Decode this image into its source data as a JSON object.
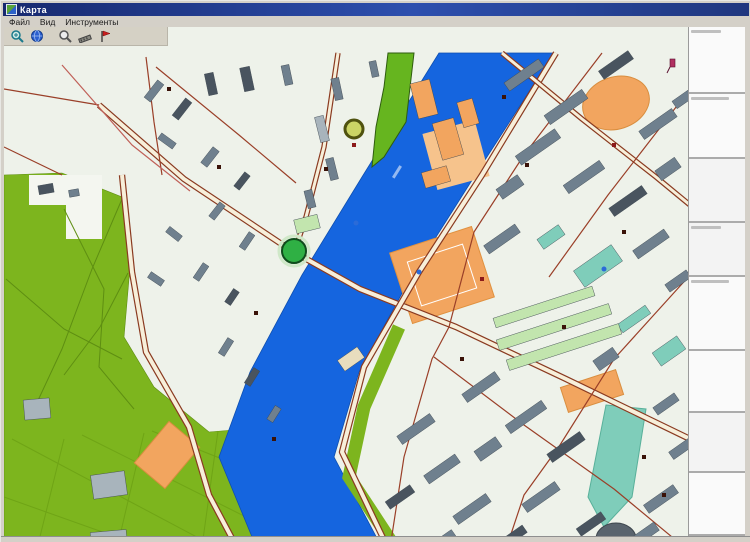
{
  "window": {
    "title": "Карта"
  },
  "menu": {
    "items": [
      {
        "id": "file",
        "label": "Файл"
      },
      {
        "id": "view",
        "label": "Вид"
      },
      {
        "id": "tools",
        "label": "Инструменты"
      }
    ]
  },
  "toolbar": {
    "buttons": [
      {
        "icon": "zoom-in-icon"
      },
      {
        "icon": "globe-icon"
      },
      {
        "icon": "search-icon"
      },
      {
        "icon": "measure-icon"
      },
      {
        "icon": "flag-icon"
      }
    ]
  },
  "sidebar": {
    "sections": [
      {
        "h": 67,
        "header": true,
        "alt": false
      },
      {
        "h": 65,
        "header": true,
        "alt": false
      },
      {
        "h": 64,
        "header": false,
        "alt": true
      },
      {
        "h": 54,
        "header": true,
        "alt": true
      },
      {
        "h": 74,
        "header": true,
        "alt": false
      },
      {
        "h": 62,
        "header": false,
        "alt": false
      },
      {
        "h": 60,
        "header": false,
        "alt": true
      },
      {
        "h": 63,
        "header": false,
        "alt": false
      }
    ]
  },
  "map": {
    "colors": {
      "bg": "#EEF2EA",
      "water": "#1565DF",
      "waterEdge": "#0E4FB0",
      "park": "#7DB51E",
      "parkLine": "#5E8E12",
      "boulevard": "#66B51F",
      "roadCase": "#8A3A20",
      "roadFill": "#F7EFDA",
      "roadMinor": "#9A3F28",
      "roadPink": "#C06058",
      "g": "#6F808E",
      "d": "#49545F",
      "l": "#A8B4BC",
      "t": "#7FCDBA",
      "m": "#C2E5AE",
      "o": "#F2A55F",
      "w": "#E8DDBE"
    },
    "river": "435,26 358,150 298,248 246,345 215,430 258,534 385,534 330,430 355,345 408,248 470,150 550,26",
    "park": "0,148 58,146 118,170 126,240 120,310 150,360 205,405 292,398 268,534 0,534",
    "notch": "25,148 98,148 98,212 62,212 62,178 25,178",
    "boulevard": "384,26 410,26 402,95 380,130 368,140 372,100 380,60",
    "bank_strip": "395,300 360,380 345,450 400,534",
    "park_paths": [
      "60,182 100,262 95,340 130,382",
      "118,172 88,242 58,322 30,382",
      "2,252 60,302 118,332",
      "124,246 96,300 60,348"
    ],
    "field_lines": [
      "8,412 238,534",
      "78,408 266,502",
      "148,404 268,452",
      "60,412 30,534",
      "140,406 110,534",
      "214,404 196,534",
      "0,470 180,534"
    ],
    "areas": [
      {
        "shape": "ellipse",
        "x": 612,
        "y": 76,
        "rx": 34,
        "ry": 26,
        "rot": -18,
        "c": "o",
        "s": "#D98E3F"
      },
      {
        "shape": "rect",
        "x": 452,
        "y": 128,
        "w": 54,
        "h": 58,
        "rot": -15,
        "c": "#F6C38C",
        "s": "none"
      },
      {
        "shape": "rect",
        "x": 438,
        "y": 248,
        "w": 86,
        "h": 74,
        "rot": -18,
        "c": "o",
        "s": "#E0913F"
      },
      {
        "shape": "rect",
        "x": 438,
        "y": 248,
        "w": 58,
        "h": 46,
        "rot": -18,
        "c": "none",
        "s": "#FFFFFF"
      },
      {
        "shape": "rect",
        "x": 163,
        "y": 428,
        "w": 54,
        "h": 40,
        "rot": -50,
        "c": "o",
        "s": "#D98E3F"
      },
      {
        "shape": "rect",
        "x": 588,
        "y": 364,
        "w": 58,
        "h": 26,
        "rot": -18,
        "c": "o",
        "s": "#D98E3F"
      },
      {
        "shape": "poly",
        "pts": "602,378 642,382 628,470 600,500 584,470",
        "c": "t",
        "s": "#58B09A"
      },
      {
        "shape": "ellipse",
        "x": 612,
        "y": 512,
        "rx": 20,
        "ry": 16,
        "rot": 0,
        "c": "#5A646E",
        "s": "#3E464E"
      }
    ],
    "roads": [
      {
        "p": "118,148 128,245 142,325 185,400 205,468 240,534",
        "w": 4,
        "major": true
      },
      {
        "p": "95,78 180,152 288,224 356,262 452,300 562,352 686,412",
        "w": 4,
        "major": true
      },
      {
        "p": "552,26 478,148 415,245 360,340 338,425 390,534",
        "w": 4,
        "major": true
      },
      {
        "p": "498,26 578,92 652,150 686,178",
        "w": 3,
        "major": true
      },
      {
        "p": "334,26 320,120 302,190 292,220",
        "w": 3,
        "major": true
      },
      {
        "p": "598,26 520,128 470,205",
        "w": 1.2,
        "c": "minor"
      },
      {
        "p": "686,62 604,168 545,250",
        "w": 1.2,
        "c": "minor"
      },
      {
        "p": "686,248 610,332",
        "w": 1.2,
        "c": "minor"
      },
      {
        "p": "430,330 520,398 610,462 668,510",
        "w": 1.2,
        "c": "minor"
      },
      {
        "p": "470,205 445,300 428,332 400,430 384,534",
        "w": 1.2,
        "c": "minor"
      },
      {
        "p": "610,332 556,418 520,468 498,534",
        "w": 1.2,
        "c": "minor"
      },
      {
        "p": "0,62 95,78",
        "w": 1.2,
        "c": "minor"
      },
      {
        "p": "142,30 150,95 158,148",
        "w": 1.2,
        "c": "minor"
      },
      {
        "p": "0,120 58,148",
        "w": 1.2,
        "c": "minor"
      },
      {
        "p": "152,40 235,108 292,156",
        "w": 1.2,
        "c": "minor"
      },
      {
        "p": "58,38 128,118 186,164",
        "w": 1.2,
        "c": "pink"
      }
    ],
    "buildings": [
      [
        "d",
        207,
        57,
        9,
        22,
        -12
      ],
      [
        "d",
        243,
        52,
        10,
        24,
        -12
      ],
      [
        "g",
        283,
        48,
        8,
        20,
        -12
      ],
      [
        "g",
        333,
        62,
        8,
        22,
        -12
      ],
      [
        "g",
        370,
        42,
        7,
        16,
        -12
      ],
      [
        "l",
        318,
        102,
        9,
        26,
        -14
      ],
      [
        "g",
        328,
        142,
        8,
        22,
        -14
      ],
      [
        "g",
        306,
        172,
        8,
        18,
        -14
      ],
      [
        "o",
        420,
        72,
        20,
        36,
        -14
      ],
      [
        "o",
        444,
        112,
        22,
        38,
        -16
      ],
      [
        "o",
        432,
        150,
        26,
        16,
        -16
      ],
      [
        "o",
        464,
        86,
        16,
        26,
        -16
      ],
      [
        "m",
        303,
        197,
        24,
        14,
        -14
      ],
      [
        "g",
        150,
        64,
        22,
        8,
        -52
      ],
      [
        "d",
        178,
        82,
        22,
        8,
        -52
      ],
      [
        "g",
        163,
        114,
        18,
        7,
        36
      ],
      [
        "g",
        206,
        130,
        20,
        8,
        -52
      ],
      [
        "d",
        238,
        154,
        18,
        7,
        -52
      ],
      [
        "g",
        213,
        184,
        18,
        7,
        -52
      ],
      [
        "g",
        243,
        214,
        18,
        7,
        -56
      ],
      [
        "g",
        170,
        207,
        16,
        7,
        38
      ],
      [
        "g",
        197,
        245,
        18,
        7,
        -56
      ],
      [
        "d",
        228,
        270,
        16,
        7,
        -56
      ],
      [
        "g",
        152,
        252,
        7,
        16,
        -56
      ],
      [
        "g",
        222,
        320,
        18,
        7,
        -58
      ],
      [
        "d",
        248,
        350,
        18,
        7,
        -58
      ],
      [
        "g",
        270,
        387,
        16,
        7,
        -58
      ],
      [
        "g",
        412,
        402,
        40,
        10,
        -35
      ],
      [
        "g",
        438,
        442,
        38,
        10,
        -35
      ],
      [
        "d",
        396,
        470,
        30,
        9,
        -35
      ],
      [
        "g",
        468,
        482,
        40,
        10,
        -35
      ],
      [
        "g",
        436,
        516,
        34,
        9,
        -35
      ],
      [
        "g",
        484,
        422,
        12,
        26,
        55
      ],
      [
        "d",
        506,
        512,
        36,
        9,
        -35
      ],
      [
        "g",
        520,
        48,
        42,
        10,
        -35
      ],
      [
        "g",
        562,
        80,
        46,
        11,
        -35
      ],
      [
        "d",
        612,
        38,
        36,
        10,
        -35
      ],
      [
        "g",
        654,
        97,
        40,
        10,
        -35
      ],
      [
        "g",
        534,
        120,
        48,
        11,
        -35
      ],
      [
        "g",
        580,
        150,
        44,
        10,
        -35
      ],
      [
        "d",
        624,
        174,
        40,
        10,
        -35
      ],
      [
        "g",
        506,
        160,
        12,
        26,
        55
      ],
      [
        "g",
        664,
        142,
        12,
        24,
        55
      ],
      [
        "g",
        682,
        70,
        28,
        9,
        -35
      ],
      [
        "g",
        498,
        212,
        38,
        10,
        -35
      ],
      [
        "t",
        547,
        210,
        12,
        26,
        55
      ],
      [
        "t",
        594,
        239,
        46,
        20,
        -35
      ],
      [
        "g",
        647,
        217,
        38,
        10,
        -35
      ],
      [
        "g",
        674,
        254,
        26,
        9,
        -35
      ],
      [
        "t",
        630,
        292,
        34,
        10,
        -35
      ],
      [
        "t",
        665,
        324,
        30,
        16,
        -35
      ],
      [
        "m",
        540,
        280,
        104,
        10,
        -18
      ],
      [
        "m",
        550,
        300,
        118,
        11,
        -18
      ],
      [
        "m",
        560,
        320,
        118,
        11,
        -18
      ],
      [
        "g",
        477,
        360,
        40,
        10,
        -35
      ],
      [
        "g",
        522,
        390,
        44,
        10,
        -35
      ],
      [
        "d",
        562,
        420,
        40,
        10,
        -35
      ],
      [
        "g",
        602,
        332,
        12,
        24,
        55
      ],
      [
        "g",
        657,
        472,
        36,
        10,
        -35
      ],
      [
        "g",
        637,
        510,
        38,
        10,
        -35
      ],
      [
        "g",
        537,
        470,
        40,
        10,
        -35
      ],
      [
        "d",
        587,
        497,
        30,
        9,
        -35
      ],
      [
        "g",
        677,
        422,
        24,
        9,
        -35
      ],
      [
        "g",
        662,
        377,
        26,
        9,
        -35
      ],
      [
        "w",
        347,
        332,
        24,
        13,
        -35
      ],
      [
        "d",
        42,
        162,
        15,
        9,
        -10
      ],
      [
        "g",
        70,
        166,
        10,
        7,
        -10
      ],
      [
        "l",
        33,
        382,
        26,
        20,
        -5
      ],
      [
        "l",
        105,
        458,
        34,
        24,
        -8
      ],
      [
        "l",
        105,
        514,
        36,
        20,
        -5
      ]
    ],
    "markers": [
      {
        "t": "sq",
        "x": 165,
        "y": 62
      },
      {
        "t": "sq",
        "x": 215,
        "y": 140
      },
      {
        "t": "sq",
        "x": 252,
        "y": 286
      },
      {
        "t": "sq",
        "x": 458,
        "y": 332
      },
      {
        "t": "sq",
        "x": 523,
        "y": 138
      },
      {
        "t": "sq",
        "x": 660,
        "y": 468
      },
      {
        "t": "sq",
        "x": 322,
        "y": 142
      },
      {
        "t": "sq",
        "x": 560,
        "y": 300
      },
      {
        "t": "sq",
        "x": 270,
        "y": 412
      },
      {
        "t": "sq",
        "x": 620,
        "y": 205
      },
      {
        "t": "sq",
        "x": 640,
        "y": 430
      },
      {
        "t": "sq",
        "x": 500,
        "y": 70
      },
      {
        "t": "dot",
        "x": 415,
        "y": 245
      },
      {
        "t": "dot",
        "x": 600,
        "y": 242
      },
      {
        "t": "dot",
        "x": 352,
        "y": 196
      },
      {
        "t": "red",
        "x": 350,
        "y": 118
      },
      {
        "t": "red",
        "x": 478,
        "y": 252
      },
      {
        "t": "red",
        "x": 610,
        "y": 118
      },
      {
        "t": "green-circle",
        "x": 290,
        "y": 224
      },
      {
        "t": "ring",
        "x": 350,
        "y": 102
      },
      {
        "t": "flag",
        "x": 666,
        "y": 32
      },
      {
        "t": "dash",
        "x": 388,
        "y": 150
      }
    ],
    "badge": {
      "x": 8,
      "y": 512,
      "w": 40,
      "h": 13
    }
  }
}
